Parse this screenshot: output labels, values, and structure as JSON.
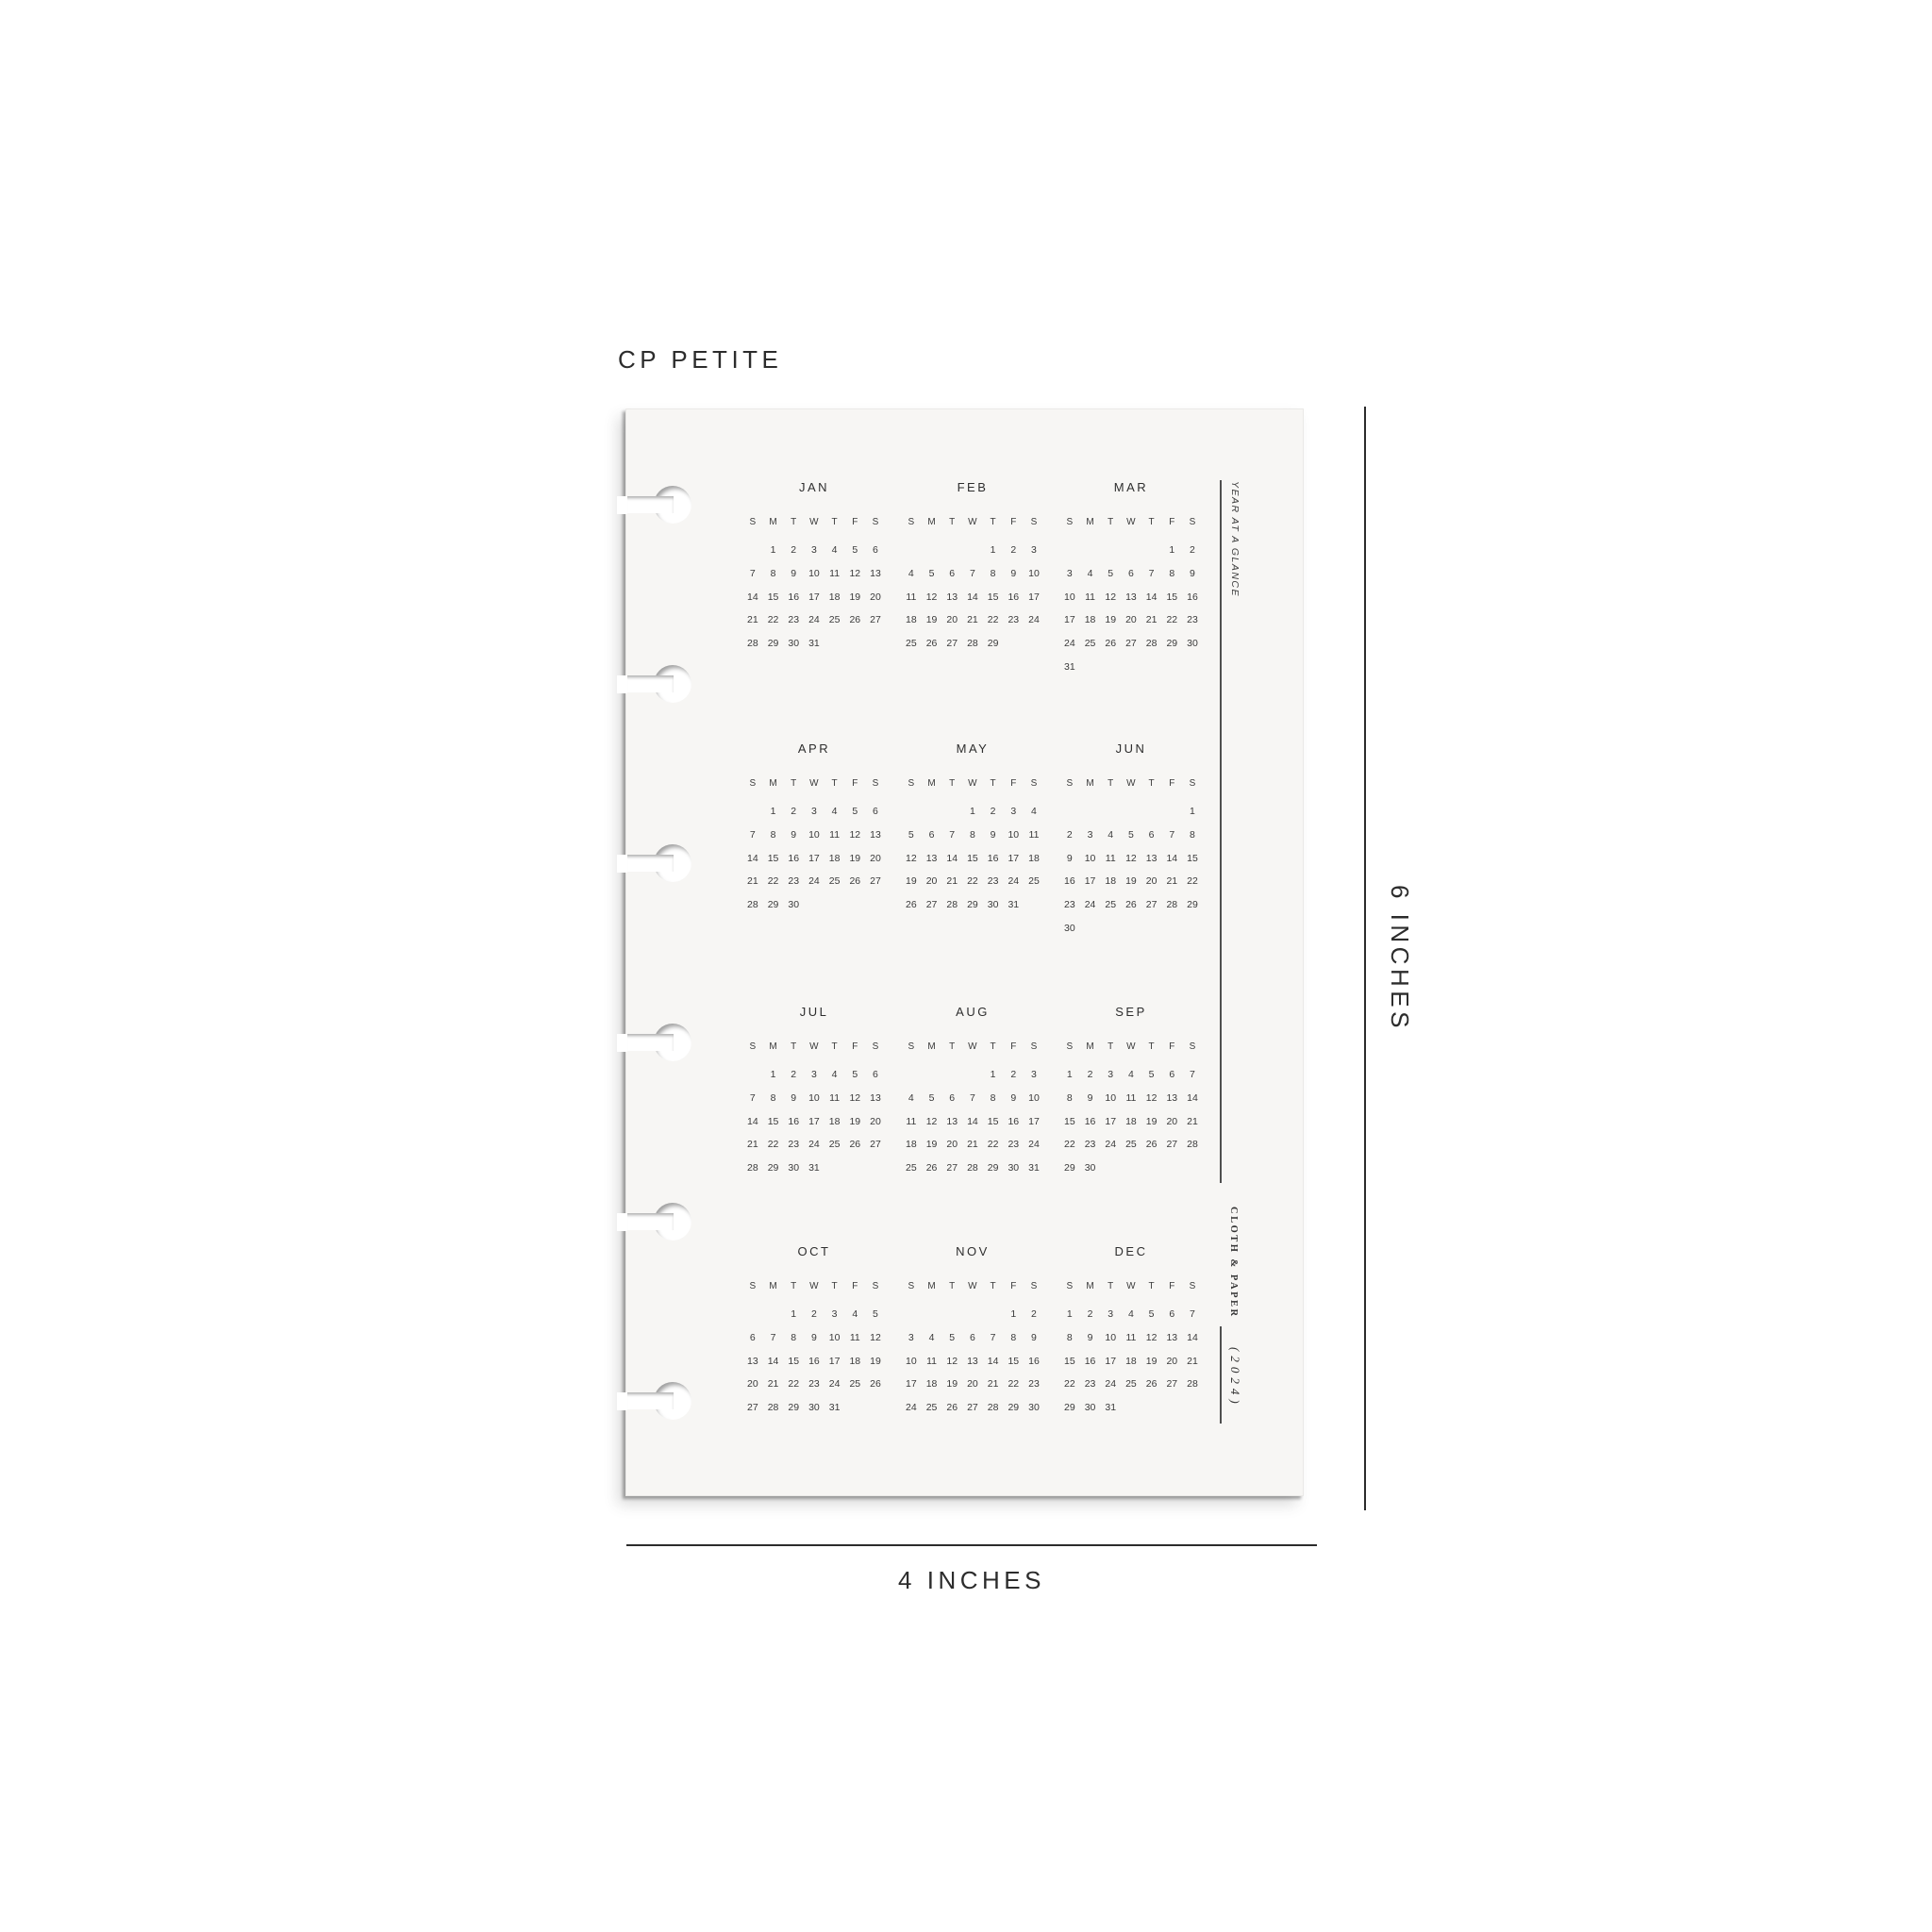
{
  "title": "CP PETITE",
  "dimensions": {
    "width_label": "4 INCHES",
    "height_label": "6 INCHES"
  },
  "sidebar": {
    "top_label": "YEAR AT A GLANCE",
    "brand": "CLOTH & PAPER",
    "year": "(2024)"
  },
  "colors": {
    "background": "#ffffff",
    "page_bg": "#f7f6f4",
    "ink": "#3a3a3a",
    "rule": "#4f4f4f",
    "dimension_ink": "#2c2c2c"
  },
  "calendar": {
    "year": "2024",
    "day_headers": [
      "S",
      "M",
      "T",
      "W",
      "T",
      "F",
      "S"
    ],
    "months": [
      {
        "name": "JAN",
        "weeks": [
          [
            "",
            "1",
            "2",
            "3",
            "4",
            "5",
            "6"
          ],
          [
            "7",
            "8",
            "9",
            "10",
            "11",
            "12",
            "13"
          ],
          [
            "14",
            "15",
            "16",
            "17",
            "18",
            "19",
            "20"
          ],
          [
            "21",
            "22",
            "23",
            "24",
            "25",
            "26",
            "27"
          ],
          [
            "28",
            "29",
            "30",
            "31",
            "",
            "",
            ""
          ]
        ]
      },
      {
        "name": "FEB",
        "weeks": [
          [
            "",
            "",
            "",
            "",
            "1",
            "2",
            "3"
          ],
          [
            "4",
            "5",
            "6",
            "7",
            "8",
            "9",
            "10"
          ],
          [
            "11",
            "12",
            "13",
            "14",
            "15",
            "16",
            "17"
          ],
          [
            "18",
            "19",
            "20",
            "21",
            "22",
            "23",
            "24"
          ],
          [
            "25",
            "26",
            "27",
            "28",
            "29",
            "",
            ""
          ]
        ]
      },
      {
        "name": "MAR",
        "weeks": [
          [
            "",
            "",
            "",
            "",
            "",
            "1",
            "2"
          ],
          [
            "3",
            "4",
            "5",
            "6",
            "7",
            "8",
            "9"
          ],
          [
            "10",
            "11",
            "12",
            "13",
            "14",
            "15",
            "16"
          ],
          [
            "17",
            "18",
            "19",
            "20",
            "21",
            "22",
            "23"
          ],
          [
            "24",
            "25",
            "26",
            "27",
            "28",
            "29",
            "30"
          ],
          [
            "31",
            "",
            "",
            "",
            "",
            "",
            ""
          ]
        ]
      },
      {
        "name": "APR",
        "weeks": [
          [
            "",
            "1",
            "2",
            "3",
            "4",
            "5",
            "6"
          ],
          [
            "7",
            "8",
            "9",
            "10",
            "11",
            "12",
            "13"
          ],
          [
            "14",
            "15",
            "16",
            "17",
            "18",
            "19",
            "20"
          ],
          [
            "21",
            "22",
            "23",
            "24",
            "25",
            "26",
            "27"
          ],
          [
            "28",
            "29",
            "30",
            "",
            "",
            "",
            ""
          ]
        ]
      },
      {
        "name": "MAY",
        "weeks": [
          [
            "",
            "",
            "",
            "1",
            "2",
            "3",
            "4"
          ],
          [
            "5",
            "6",
            "7",
            "8",
            "9",
            "10",
            "11"
          ],
          [
            "12",
            "13",
            "14",
            "15",
            "16",
            "17",
            "18"
          ],
          [
            "19",
            "20",
            "21",
            "22",
            "23",
            "24",
            "25"
          ],
          [
            "26",
            "27",
            "28",
            "29",
            "30",
            "31",
            ""
          ]
        ]
      },
      {
        "name": "JUN",
        "weeks": [
          [
            "",
            "",
            "",
            "",
            "",
            "",
            "1"
          ],
          [
            "2",
            "3",
            "4",
            "5",
            "6",
            "7",
            "8"
          ],
          [
            "9",
            "10",
            "11",
            "12",
            "13",
            "14",
            "15"
          ],
          [
            "16",
            "17",
            "18",
            "19",
            "20",
            "21",
            "22"
          ],
          [
            "23",
            "24",
            "25",
            "26",
            "27",
            "28",
            "29"
          ],
          [
            "30",
            "",
            "",
            "",
            "",
            "",
            ""
          ]
        ]
      },
      {
        "name": "JUL",
        "weeks": [
          [
            "",
            "1",
            "2",
            "3",
            "4",
            "5",
            "6"
          ],
          [
            "7",
            "8",
            "9",
            "10",
            "11",
            "12",
            "13"
          ],
          [
            "14",
            "15",
            "16",
            "17",
            "18",
            "19",
            "20"
          ],
          [
            "21",
            "22",
            "23",
            "24",
            "25",
            "26",
            "27"
          ],
          [
            "28",
            "29",
            "30",
            "31",
            "",
            "",
            ""
          ]
        ]
      },
      {
        "name": "AUG",
        "weeks": [
          [
            "",
            "",
            "",
            "",
            "1",
            "2",
            "3"
          ],
          [
            "4",
            "5",
            "6",
            "7",
            "8",
            "9",
            "10"
          ],
          [
            "11",
            "12",
            "13",
            "14",
            "15",
            "16",
            "17"
          ],
          [
            "18",
            "19",
            "20",
            "21",
            "22",
            "23",
            "24"
          ],
          [
            "25",
            "26",
            "27",
            "28",
            "29",
            "30",
            "31"
          ]
        ]
      },
      {
        "name": "SEP",
        "weeks": [
          [
            "1",
            "2",
            "3",
            "4",
            "5",
            "6",
            "7"
          ],
          [
            "8",
            "9",
            "10",
            "11",
            "12",
            "13",
            "14"
          ],
          [
            "15",
            "16",
            "17",
            "18",
            "19",
            "20",
            "21"
          ],
          [
            "22",
            "23",
            "24",
            "25",
            "26",
            "27",
            "28"
          ],
          [
            "29",
            "30",
            "",
            "",
            "",
            "",
            ""
          ]
        ]
      },
      {
        "name": "OCT",
        "weeks": [
          [
            "",
            "",
            "1",
            "2",
            "3",
            "4",
            "5"
          ],
          [
            "6",
            "7",
            "8",
            "9",
            "10",
            "11",
            "12"
          ],
          [
            "13",
            "14",
            "15",
            "16",
            "17",
            "18",
            "19"
          ],
          [
            "20",
            "21",
            "22",
            "23",
            "24",
            "25",
            "26"
          ],
          [
            "27",
            "28",
            "29",
            "30",
            "31",
            "",
            ""
          ]
        ]
      },
      {
        "name": "NOV",
        "weeks": [
          [
            "",
            "",
            "",
            "",
            "",
            "1",
            "2"
          ],
          [
            "3",
            "4",
            "5",
            "6",
            "7",
            "8",
            "9"
          ],
          [
            "10",
            "11",
            "12",
            "13",
            "14",
            "15",
            "16"
          ],
          [
            "17",
            "18",
            "19",
            "20",
            "21",
            "22",
            "23"
          ],
          [
            "24",
            "25",
            "26",
            "27",
            "28",
            "29",
            "30"
          ]
        ]
      },
      {
        "name": "DEC",
        "weeks": [
          [
            "1",
            "2",
            "3",
            "4",
            "5",
            "6",
            "7"
          ],
          [
            "8",
            "9",
            "10",
            "11",
            "12",
            "13",
            "14"
          ],
          [
            "15",
            "16",
            "17",
            "18",
            "19",
            "20",
            "21"
          ],
          [
            "22",
            "23",
            "24",
            "25",
            "26",
            "27",
            "28"
          ],
          [
            "29",
            "30",
            "31",
            "",
            "",
            "",
            ""
          ]
        ]
      }
    ]
  }
}
